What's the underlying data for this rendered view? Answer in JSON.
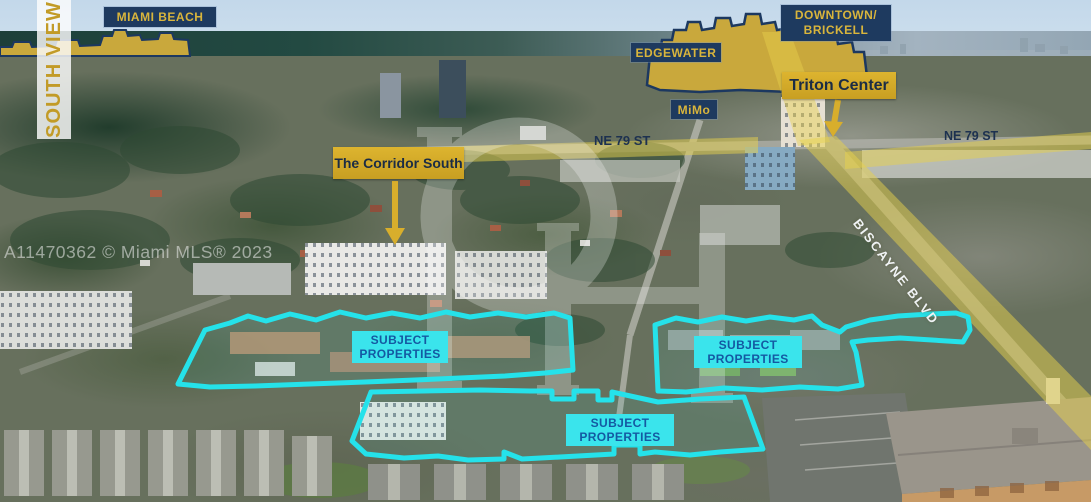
{
  "view": {
    "label": "SOUTH VIEW"
  },
  "listing_watermark": "A11470362 © Miami MLS® 2023",
  "monogram": "PH",
  "areas": {
    "miami_beach": "MIAMI BEACH",
    "downtown_line1": "DOWNTOWN/",
    "downtown_line2": "BRICKELL",
    "edgewater": "EDGEWATER",
    "mimo": "MiMo"
  },
  "landmarks": {
    "triton": "Triton Center",
    "corridor": "The Corridor South"
  },
  "streets": {
    "ne79_west": "NE 79 ST",
    "ne79_east": "NE 79 ST",
    "biscayne": "BISCAYNE BLVD"
  },
  "subject_areas": [
    {
      "line1": "SUBJECT",
      "line2": "PROPERTIES"
    },
    {
      "line1": "SUBJECT",
      "line2": "PROPERTIES"
    },
    {
      "line1": "SUBJECT",
      "line2": "PROPERTIES"
    }
  ],
  "colors": {
    "banner_navy": "#1e3a5f",
    "banner_gold_text": "#d9b53c",
    "gold_banner_bg": "#d4a928",
    "cyan_outline": "#25e2ea",
    "subject_label_bg": "#3ae4ec",
    "subject_label_text": "#1459a2",
    "road_highlight": "#e8d14b"
  }
}
